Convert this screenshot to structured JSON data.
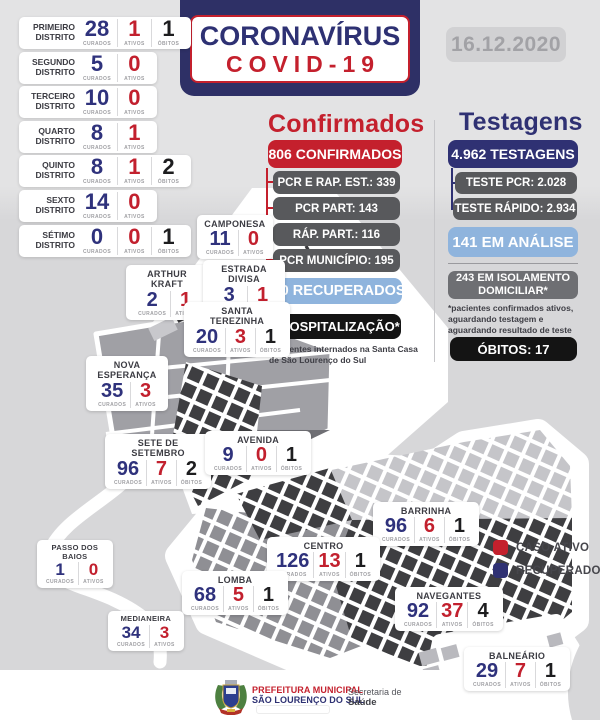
{
  "header": {
    "title_line1": "CORONAVÍRUS",
    "title_line2": "COVID-19",
    "date": "16.12.2020"
  },
  "labels": {
    "curados": "CURADOS",
    "ativos": "ATIVOS",
    "obitos": "ÓBITOS"
  },
  "districts": [
    {
      "name": "PRIMEIRO DISTRITO",
      "curados": "28",
      "ativos": "1",
      "obitos": "1"
    },
    {
      "name": "SEGUNDO DISTRITO",
      "curados": "5",
      "ativos": "0"
    },
    {
      "name": "TERCEIRO DISTRITO",
      "curados": "10",
      "ativos": "0"
    },
    {
      "name": "QUARTO DISTRITO",
      "curados": "8",
      "ativos": "1"
    },
    {
      "name": "QUINTO DISTRITO",
      "curados": "8",
      "ativos": "1",
      "obitos": "2"
    },
    {
      "name": "SEXTO DISTRITO",
      "curados": "14",
      "ativos": "0"
    },
    {
      "name": "SÉTIMO DISTRITO",
      "curados": "0",
      "ativos": "0",
      "obitos": "1"
    }
  ],
  "confirmados": {
    "title": "Confirmados",
    "total": "806 CONFIRMADOS",
    "breakdown": [
      "PCR E RAP. EST.: 339",
      "PCR PART: 143",
      "RÁP. PART.: 116",
      "PCR MUNICÍPIO: 195"
    ],
    "recuperados": "700 RECUPERADOS",
    "hospitalizacao": "4 HOSPITALIZAÇÃO*",
    "footnote": "*pacientes internados na Santa Casa de São Lourenço do Sul"
  },
  "testagens": {
    "title": "Testagens",
    "total": "4.962 TESTAGENS",
    "breakdown": [
      "TESTE PCR: 2.028",
      "TESTE RÁPIDO: 2.934"
    ],
    "analise": "141 EM ANÁLISE",
    "isolamento": "243 EM ISOLAMENTO DOMICILIAR*",
    "footnote": "*pacientes confirmados ativos, aguardando testagem e aguardando resultado de teste",
    "obitos": "ÓBITOS: 17"
  },
  "neighborhoods": [
    {
      "name": "CAMPONESA",
      "curados": "11",
      "ativos": "0"
    },
    {
      "name": "ARTHUR KRAFT",
      "curados": "2",
      "ativos": "1"
    },
    {
      "name": "ESTRADA DIVISA",
      "curados": "3",
      "ativos": "1"
    },
    {
      "name": "SANTA TEREZINHA",
      "curados": "20",
      "ativos": "3",
      "obitos": "1"
    },
    {
      "name": "NOVA ESPERANÇA",
      "curados": "35",
      "ativos": "3"
    },
    {
      "name": "SETE DE SETEMBRO",
      "curados": "96",
      "ativos": "7",
      "obitos": "2"
    },
    {
      "name": "AVENIDA",
      "curados": "9",
      "ativos": "0",
      "obitos": "1"
    },
    {
      "name": "BARRINHA",
      "curados": "96",
      "ativos": "6",
      "obitos": "1"
    },
    {
      "name": "CENTRO",
      "curados": "126",
      "ativos": "13",
      "obitos": "1"
    },
    {
      "name": "LOMBA",
      "curados": "68",
      "ativos": "5",
      "obitos": "1"
    },
    {
      "name": "NAVEGANTES",
      "curados": "92",
      "ativos": "37",
      "obitos": "4"
    },
    {
      "name": "MEDIANEIRA",
      "curados": "34",
      "ativos": "3"
    },
    {
      "name": "PASSO DOS BAIOS",
      "curados": "1",
      "ativos": "0"
    },
    {
      "name": "BALNEÁRIO",
      "curados": "29",
      "ativos": "7",
      "obitos": "1"
    }
  ],
  "legend": {
    "active": "CASO ATIVO",
    "recovered": "RECUPERADO"
  },
  "footer": {
    "org_line1": "PREFEITURA MUNICIPAL",
    "org_line2": "SÃO LOURENÇO DO SUL",
    "dept_line1": "Secretaria de",
    "dept_line2": "Saúde"
  },
  "colors": {
    "navy": "#2f3173",
    "red": "#c4202d",
    "light_blue": "#8fb4dd",
    "gray_box": "#58595c",
    "black_box": "#141414",
    "map_dark": "#3e3e41",
    "map_mid": "#8f8f94",
    "map_light": "#c5c5c9"
  }
}
